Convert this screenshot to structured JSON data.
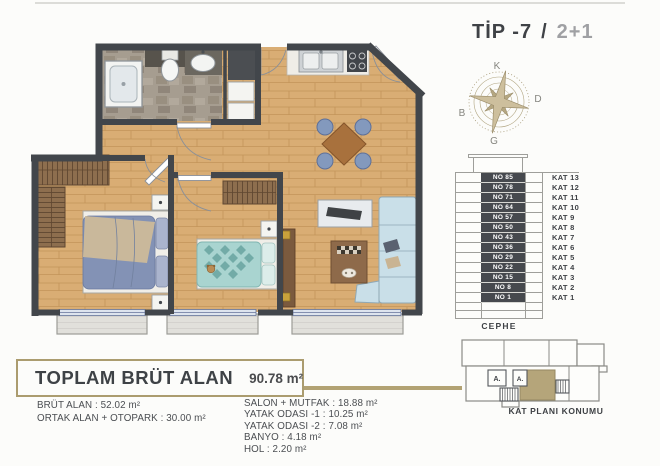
{
  "title": {
    "type": "TİP -7",
    "sep": "/",
    "plan": "2+1"
  },
  "compass": {
    "n": "K",
    "e": "D",
    "s": "G",
    "w": "B"
  },
  "elevation": {
    "caption": "CEPHE",
    "rows": [
      {
        "no": "NO 85",
        "kat": "KAT 13"
      },
      {
        "no": "NO 78",
        "kat": "KAT 12"
      },
      {
        "no": "NO 71",
        "kat": "KAT 11"
      },
      {
        "no": "NO 64",
        "kat": "KAT 10"
      },
      {
        "no": "NO 57",
        "kat": "KAT 9"
      },
      {
        "no": "NO 50",
        "kat": "KAT 8"
      },
      {
        "no": "NO 43",
        "kat": "KAT 7"
      },
      {
        "no": "NO 36",
        "kat": "KAT 6"
      },
      {
        "no": "NO 29",
        "kat": "KAT 5"
      },
      {
        "no": "NO 22",
        "kat": "KAT 4"
      },
      {
        "no": "NO 15",
        "kat": "KAT 3"
      },
      {
        "no": "NO 8",
        "kat": "KAT 2"
      },
      {
        "no": "NO 1",
        "kat": "KAT 1"
      }
    ]
  },
  "location": {
    "label": "KAT PLANI KONUMU",
    "core_a": "A.",
    "core_b": "A."
  },
  "summary": {
    "title": "TOPLAM BRÜT ALAN",
    "total": "90.78 m²",
    "left": [
      "BRÜT ALAN : 52.02 m²",
      "ORTAK ALAN + OTOPARK : 30.00 m²"
    ],
    "right": [
      "SALON + MUTFAK : 18.88 m²",
      "YATAK ODASI -1 : 10.25 m²",
      "YATAK ODASI -2 : 7.08 m²",
      "BANYO : 4.18 m²",
      "HOL : 2.20 m²"
    ]
  },
  "colors": {
    "accent_tan": "#b2a273",
    "wall": "#42464b",
    "wood": "#d9ad74",
    "text_dark": "#3e4145",
    "text_gray": "#9fa0a3",
    "highlight_unit": "#b5a57a"
  }
}
